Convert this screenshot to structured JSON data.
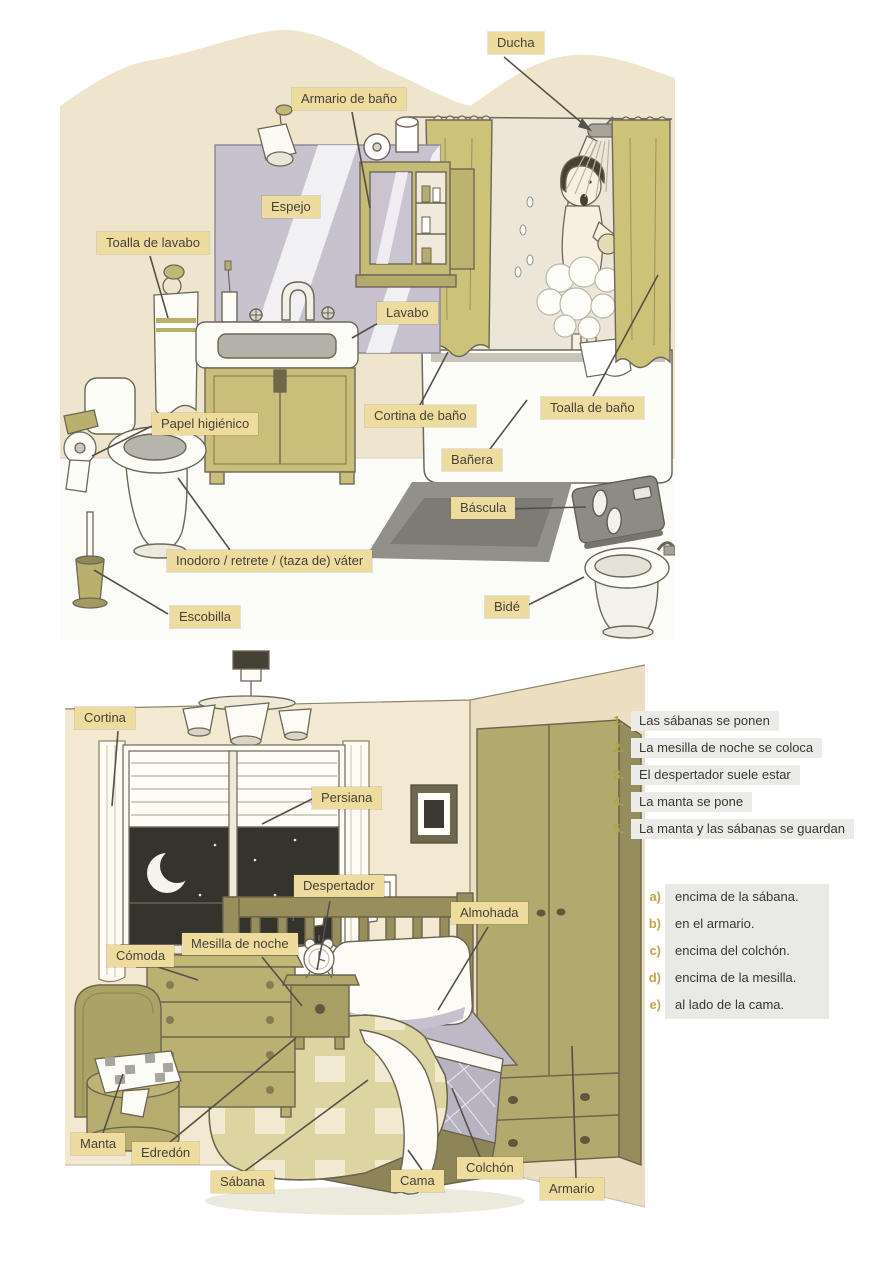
{
  "bathroom": {
    "labels": {
      "ducha": "Ducha",
      "armario_de_bano": "Armario de baño",
      "espejo": "Espejo",
      "toalla_de_lavabo": "Toalla de lavabo",
      "lavabo": "Lavabo",
      "papel_higienico": "Papel higiénico",
      "cortina_de_bano": "Cortina de baño",
      "toalla_de_bano": "Toalla de baño",
      "banera": "Bañera",
      "bascula": "Báscula",
      "inodoro": "Inodoro / retrete / (taza de) váter",
      "escobilla": "Escobilla",
      "bide": "Bidé"
    }
  },
  "bedroom": {
    "labels": {
      "cortina": "Cortina",
      "persiana": "Persiana",
      "despertador": "Despertador",
      "almohada": "Almohada",
      "comoda": "Cómoda",
      "mesilla_de_noche": "Mesilla de noche",
      "manta": "Manta",
      "edredon": "Edredón",
      "sabana": "Sábana",
      "cama": "Cama",
      "colchon": "Colchón",
      "armario": "Armario"
    }
  },
  "exercise": {
    "sentences": [
      {
        "num": "1.",
        "text": "Las sábanas se ponen"
      },
      {
        "num": "2.",
        "text": "La mesilla de noche se coloca"
      },
      {
        "num": "3.",
        "text": "El despertador suele estar"
      },
      {
        "num": "4.",
        "text": "La manta se pone"
      },
      {
        "num": "5.",
        "text": "La manta y las sábanas se guardan"
      }
    ],
    "options": [
      {
        "letter": "a)",
        "text": "encima de la sábana."
      },
      {
        "letter": "b)",
        "text": "en el armario."
      },
      {
        "letter": "c)",
        "text": "encima del colchón."
      },
      {
        "letter": "d)",
        "text": "encima de la mesilla."
      },
      {
        "letter": "e)",
        "text": "al lado de la cama."
      }
    ]
  },
  "colors": {
    "label_background": "#eedc9e",
    "number_accent": "#b3a14c",
    "letter_accent": "#bfa64d",
    "olive_furniture": "#c6bc79",
    "wall_beige": "#f0e6cf",
    "night_sky": "#34342d"
  }
}
